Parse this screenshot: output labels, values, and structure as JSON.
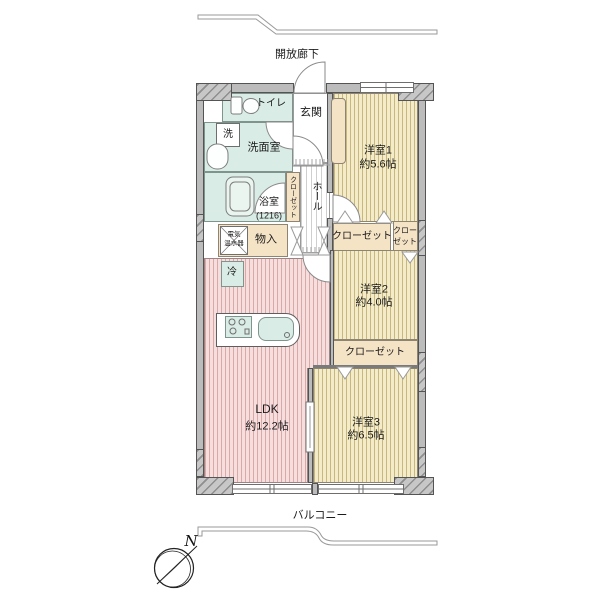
{
  "labels": {
    "corridor": "開放廊下",
    "toilet": "トイレ",
    "entrance": "玄関",
    "washer": "洗",
    "washroom": "洗面室",
    "bathroom": "浴室",
    "bathroom_size": "(1216)",
    "closet_hall": "クローゼット",
    "hall": "ホール",
    "room1": "洋室1",
    "room1_size": "約5.6帖",
    "heater_line1": "電気",
    "heater_line2": "温水器",
    "storage": "物入",
    "closet_room1": "クローゼット",
    "closet_small_line1": "クロー",
    "closet_small_line2": "ゼット",
    "fridge": "冷",
    "room2": "洋室2",
    "room2_size": "約4.0帖",
    "closet_room2": "クローゼット",
    "ldk": "LDK",
    "ldk_size": "約12.2帖",
    "room3": "洋室3",
    "room3_size": "約6.5帖",
    "balcony": "バルコニー",
    "compass_north": "N"
  },
  "colors": {
    "wall_fill": "#bcbcbc",
    "wall_outline": "#545454",
    "wet_room": "#d9ece6",
    "closet_beige": "#f5e3c6",
    "western_room_bg": "#f4ecc8",
    "western_room_stripe": "#c9b87e",
    "ldk_bg": "#f7dede",
    "ldk_stripe": "#dba8a8",
    "hall_stripe": "#cfcfcf",
    "compass_needle": "#111111"
  }
}
